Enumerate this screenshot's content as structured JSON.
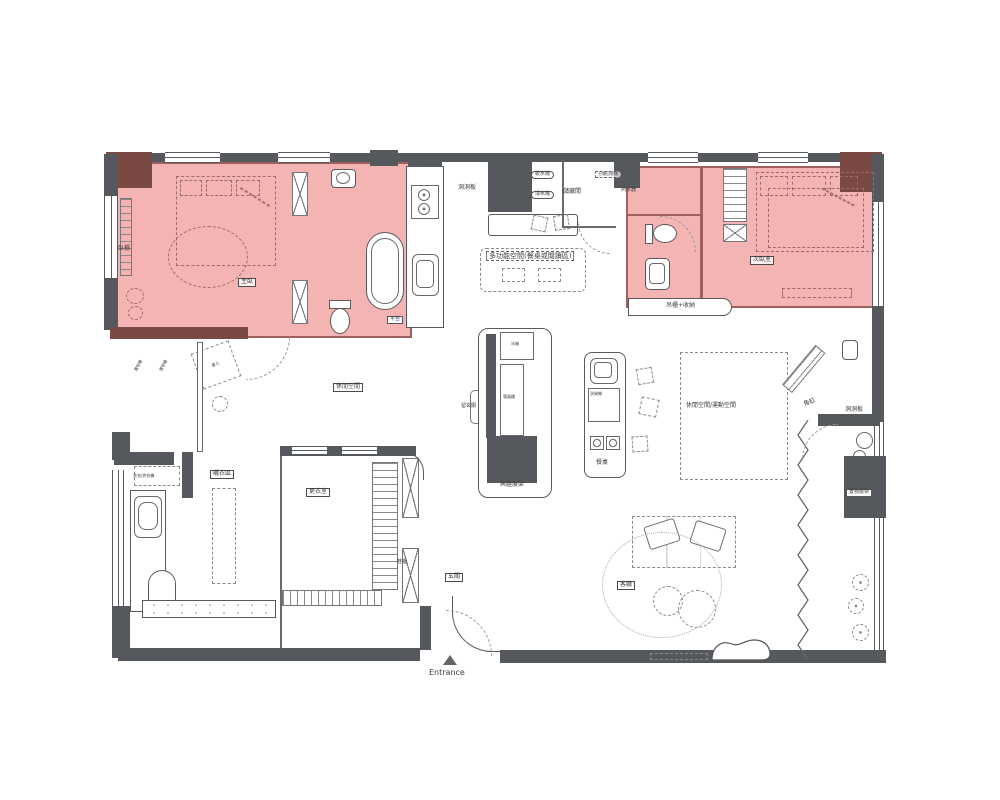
{
  "page": {
    "type": "apartment-floor-plan",
    "background": "#ffffff"
  },
  "colors": {
    "highlight_room_fill": "#f2a3a3",
    "highlight_room_border": "#a05f5f",
    "wall_dark": "#55585d",
    "wall_maroon": "#7b4944",
    "line": "#5a5a5a"
  },
  "labels": [
    {
      "id": "label-window-seat",
      "text": "臥榻",
      "x": 118,
      "y": 246,
      "style": "plain",
      "fs": 6
    },
    {
      "id": "label-master-bedroom",
      "text": "主臥",
      "x": 238,
      "y": 278,
      "style": "boxed",
      "fs": 6
    },
    {
      "id": "label-storage-cabinet-1",
      "text": "置物櫃",
      "x": 134,
      "y": 370,
      "style": "plain",
      "fs": 4,
      "rot": -62
    },
    {
      "id": "label-storage-cabinet-2",
      "text": "置物櫃",
      "x": 159,
      "y": 370,
      "style": "plain",
      "fs": 4,
      "rot": -62
    },
    {
      "id": "label-platform",
      "text": "平台",
      "x": 387,
      "y": 316,
      "style": "chip",
      "fs": 5
    },
    {
      "id": "label-pegboard-kitchen",
      "text": "洞洞板",
      "x": 458,
      "y": 185,
      "style": "plain",
      "fs": 6
    },
    {
      "id": "label-water-softener",
      "text": "軟水機",
      "x": 531,
      "y": 171,
      "style": "oval",
      "fs": 5
    },
    {
      "id": "label-water-purifier",
      "text": "淨水機",
      "x": 531,
      "y": 191,
      "style": "oval",
      "fs": 5
    },
    {
      "id": "label-storage-room",
      "text": "儲藏間",
      "x": 563,
      "y": 189,
      "style": "plain",
      "fs": 6
    },
    {
      "id": "label-recycle-bins",
      "text": "分類回收桶",
      "x": 595,
      "y": 171,
      "style": "dashbox",
      "fs": 4
    },
    {
      "id": "label-water-heater",
      "text": "熱水器",
      "x": 621,
      "y": 188,
      "style": "plain",
      "fs": 5
    },
    {
      "id": "label-multifunction-space",
      "text": "多功能空間(餐桌或閱讀區)",
      "x": 486,
      "y": 251,
      "style": "dashbox",
      "fs": 7
    },
    {
      "id": "label-second-bedroom",
      "text": "次臥室",
      "x": 750,
      "y": 256,
      "style": "boxed",
      "fs": 6
    },
    {
      "id": "label-hanging-cabinet-storage",
      "text": "吊櫃+收納",
      "x": 666,
      "y": 303,
      "style": "plain",
      "fs": 6
    },
    {
      "id": "label-leisure-space",
      "text": "休閒空間",
      "x": 333,
      "y": 383,
      "style": "boxed",
      "fs": 6
    },
    {
      "id": "label-dressing-room",
      "text": "更衣室",
      "x": 306,
      "y": 488,
      "style": "boxed",
      "fs": 6
    },
    {
      "id": "label-reserved-entry",
      "text": "留玄關",
      "x": 461,
      "y": 404,
      "style": "plain",
      "fs": 5
    },
    {
      "id": "label-fridge",
      "text": "冰箱",
      "x": 511,
      "y": 342,
      "style": "plain",
      "fs": 4
    },
    {
      "id": "label-appliance-cabinet",
      "text": "電器櫃",
      "x": 503,
      "y": 395,
      "style": "plain",
      "fs": 4
    },
    {
      "id": "label-hobby-shelf",
      "text": "興趣展架",
      "x": 500,
      "y": 482,
      "style": "plain",
      "fs": 6
    },
    {
      "id": "label-dishwasher",
      "text": "洗碗機",
      "x": 590,
      "y": 392,
      "style": "plain",
      "fs": 4
    },
    {
      "id": "label-dining-table",
      "text": "餐桌",
      "x": 596,
      "y": 460,
      "style": "plain",
      "fs": 6
    },
    {
      "id": "label-leisure-exercise",
      "text": "休閒空間/運動空間",
      "x": 686,
      "y": 403,
      "style": "plain",
      "fs": 6
    },
    {
      "id": "label-corner-tank",
      "text": "角缸",
      "x": 803,
      "y": 402,
      "style": "plain",
      "fs": 6,
      "rot": -20
    },
    {
      "id": "label-pegboard-balcony",
      "text": "洞洞板",
      "x": 845,
      "y": 407,
      "style": "plain",
      "fs": 6
    },
    {
      "id": "label-shelf-rack",
      "text": "置物層架",
      "x": 846,
      "y": 489,
      "style": "chip",
      "fs": 5
    },
    {
      "id": "label-drying-area",
      "text": "曬衣區",
      "x": 210,
      "y": 470,
      "style": "boxed",
      "fs": 6
    },
    {
      "id": "label-washer-dryer",
      "text": "洗衣/烘衣機",
      "x": 133,
      "y": 474,
      "style": "plain",
      "fs": 4
    },
    {
      "id": "label-shoe-cabinet",
      "text": "鞋櫃",
      "x": 397,
      "y": 560,
      "style": "plain",
      "fs": 5
    },
    {
      "id": "label-entry-hall",
      "text": "玄關",
      "x": 445,
      "y": 573,
      "style": "boxed",
      "fs": 6
    },
    {
      "id": "label-living-room",
      "text": "客廳",
      "x": 617,
      "y": 581,
      "style": "boxed",
      "fs": 6
    },
    {
      "id": "label-side-table",
      "text": "邊几",
      "x": 211,
      "y": 364,
      "style": "plain",
      "fs": 4,
      "rot": -20
    },
    {
      "id": "label-entrance",
      "text": "Entrance",
      "x": 429,
      "y": 668,
      "style": "plain",
      "fs": 8
    }
  ]
}
